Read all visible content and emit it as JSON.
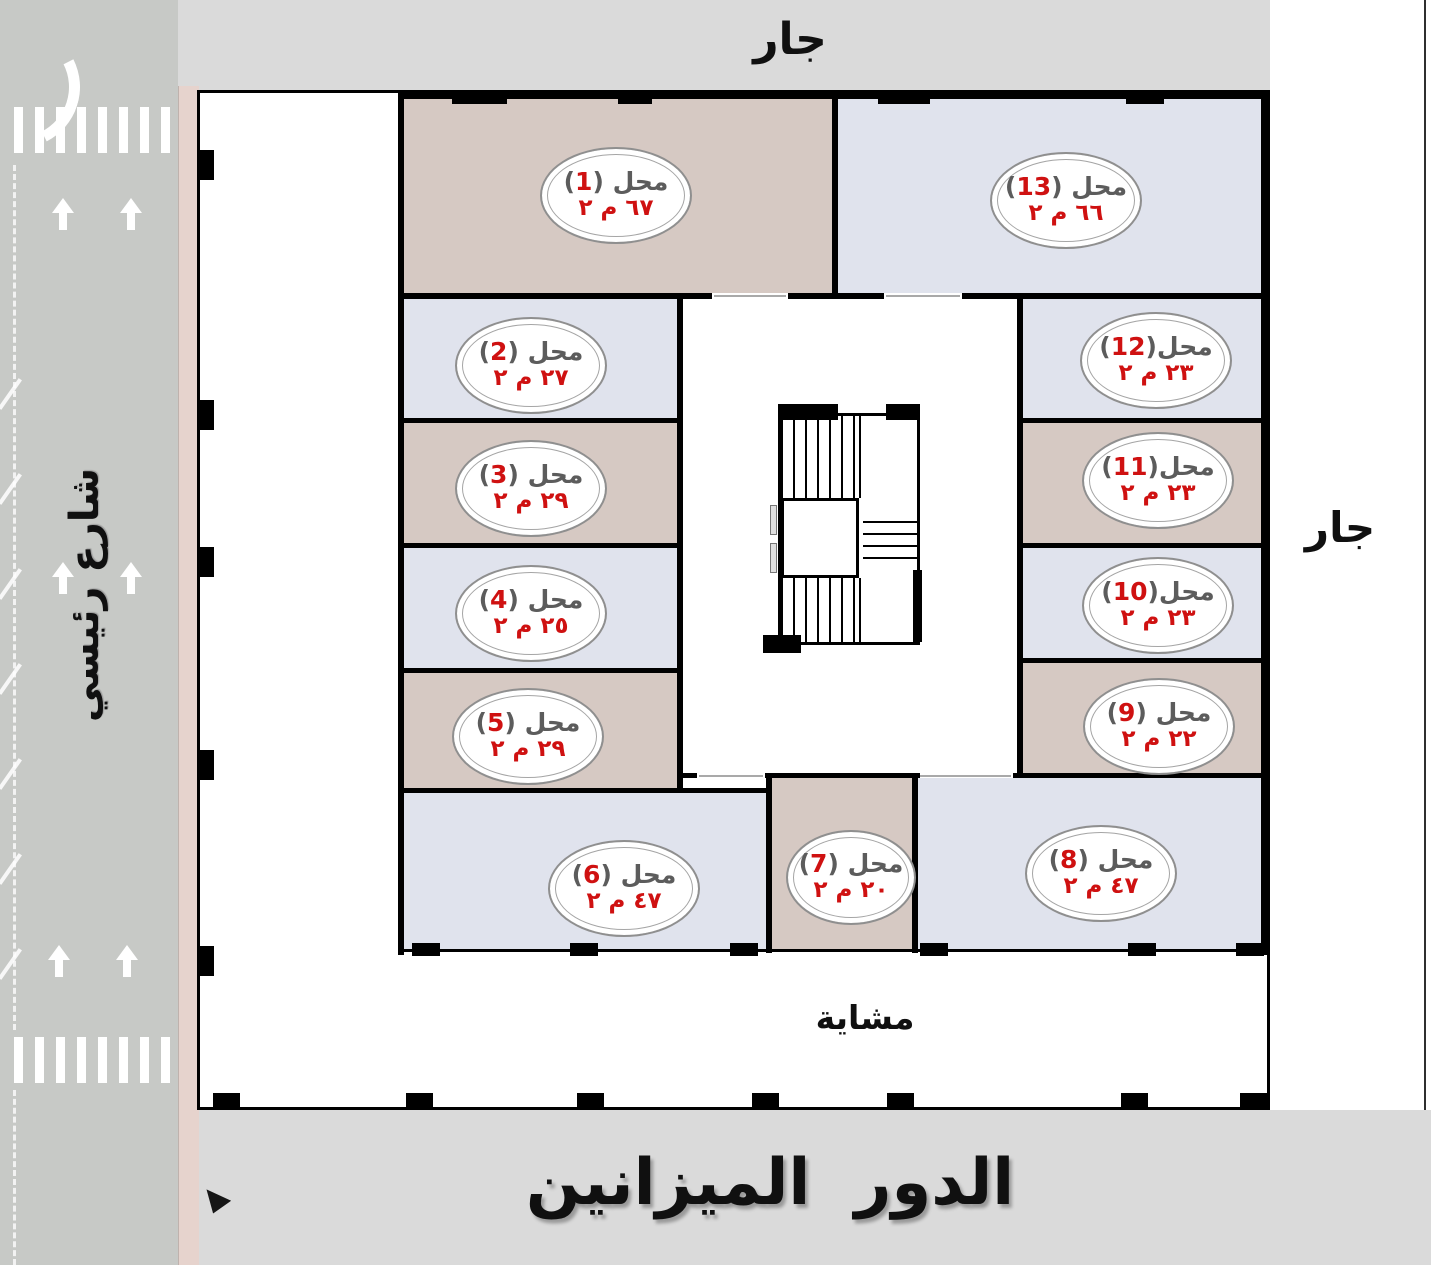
{
  "plan": {
    "surroundings": {
      "top": "جار",
      "right": "جار",
      "street": "شارع رئيسي"
    },
    "walkway": "مشاية",
    "floor_title": "الدور الميزانين",
    "shop_prefix": "محل",
    "punct": {
      "open": "(",
      "close": ")"
    },
    "shops": [
      {
        "number": "1",
        "area": "٦٧ م ٢"
      },
      {
        "number": "2",
        "area": "٢٧ م ٢"
      },
      {
        "number": "3",
        "area": "٢٩ م ٢"
      },
      {
        "number": "4",
        "area": "٢٥ م ٢"
      },
      {
        "number": "5",
        "area": "٢٩ م ٢"
      },
      {
        "number": "6",
        "area": "٤٧ م ٢"
      },
      {
        "number": "7",
        "area": "٢٠ م ٢"
      },
      {
        "number": "8",
        "area": "٤٧ م ٢"
      },
      {
        "number": "9",
        "area": "٢٢ م ٢"
      },
      {
        "number": "10",
        "area": "٢٣ م ٢"
      },
      {
        "number": "11",
        "area": "٢٣ م ٢"
      },
      {
        "number": "12",
        "area": "٢٣ م ٢"
      },
      {
        "number": "13",
        "area": "٦٦ م ٢"
      }
    ]
  },
  "colors": {
    "room_beige": "#d6c9c3",
    "room_lavender": "#e0e3ed",
    "accent_red": "#cf1111",
    "label_gray": "#5c5c5c",
    "wall_black": "#000000",
    "road_gray": "#c7c9c6",
    "sidewalk_pink": "#e6d3cd",
    "background_gray": "#dadada"
  }
}
